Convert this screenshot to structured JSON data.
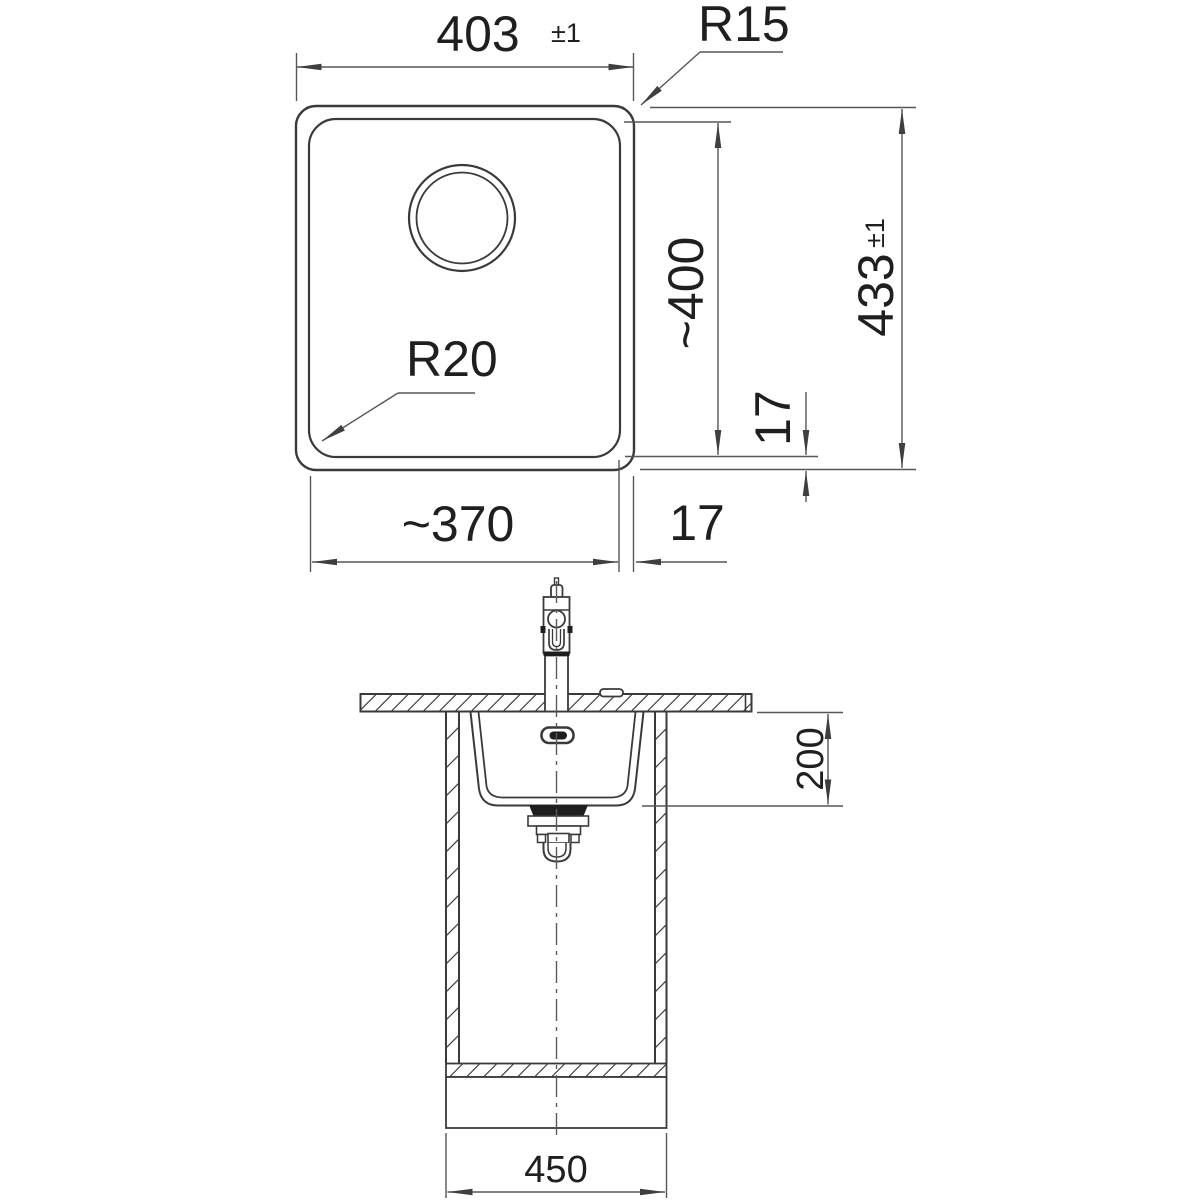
{
  "colors": {
    "background": "#ffffff",
    "object_line": "#3a3a3a",
    "dimension_line": "#565656",
    "text": "#1f1f1f",
    "fill_dark": "#1e1e1e"
  },
  "plan_view": {
    "dim_overall_width": {
      "value": "403",
      "tolerance": "±1"
    },
    "label_corner_radius_outer": "R15",
    "label_corner_radius_bowl": "R20",
    "dim_bowl_length": "~400",
    "dim_overall_length": {
      "value": "433",
      "tolerance": "±1"
    },
    "dim_rim_bottom": "17",
    "dim_bowl_width": "~370",
    "dim_rim_right": "17"
  },
  "section_view": {
    "dim_bowl_depth": "200",
    "dim_cabinet_width": "450"
  }
}
